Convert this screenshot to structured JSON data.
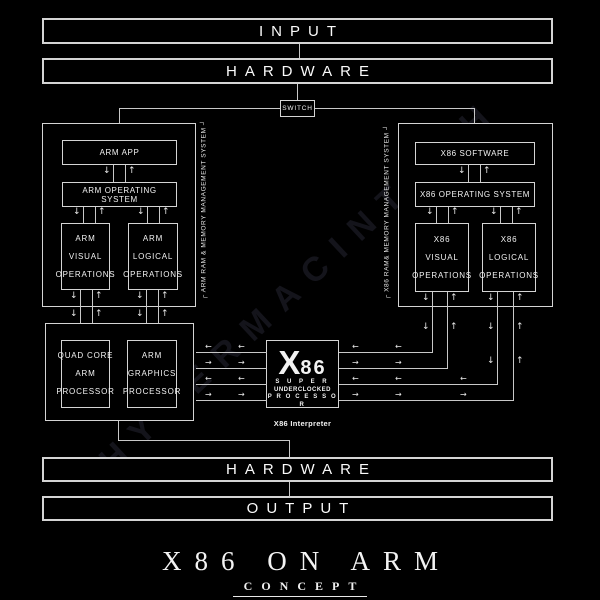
{
  "flow": {
    "input": "INPUT",
    "hardware_top": "HARDWARE",
    "switch": "SWITCH",
    "hardware_bottom": "HARDWARE",
    "output": "OUTPUT"
  },
  "arm_side": {
    "app": "ARM APP",
    "os": "ARM OPERATING SYSTEM",
    "visual": "ARM\nVISUAL\nOPERATIONS",
    "logical": "ARM\nLOGICAL\nOPERATIONS",
    "ram": "┌ ARM RAM & MEMORY MANAGEMENT SYSTEM ┘"
  },
  "x86_side": {
    "software": "X86 SOFTWARE",
    "os": "X86 OPERATING SYSTEM",
    "visual": "X86\nVISUAL\nOPERATIONS",
    "logical": "X86\nLOGICAL\nOPERATIONS",
    "ram": "┌ X86 RAM& MEMORY MANAGEMENT SYSTEM ┘"
  },
  "arm_hardware": {
    "cpu": "QUAD CORE\nARM\nPROCESSOR",
    "gpu": "ARM\nGRAPHICS\nPROCESSOR"
  },
  "interpreter": {
    "x": "X",
    "num": "86",
    "line_super": "S U P E R",
    "line_underclocked": "UNDERCLOCKED",
    "line_processor": "P R O C E S S O R",
    "badge": "X86 Interpreter"
  },
  "footer": {
    "title": "X86 ON ARM",
    "subtitle": "CONCEPT"
  },
  "watermark": "HYPERMACINTOSH",
  "colors": {
    "background": "#000000",
    "line": "#c8c8c8",
    "text": "#f2f2f2"
  },
  "icons": {
    "down": "↓",
    "up": "↑",
    "left": "←",
    "right": "→"
  }
}
